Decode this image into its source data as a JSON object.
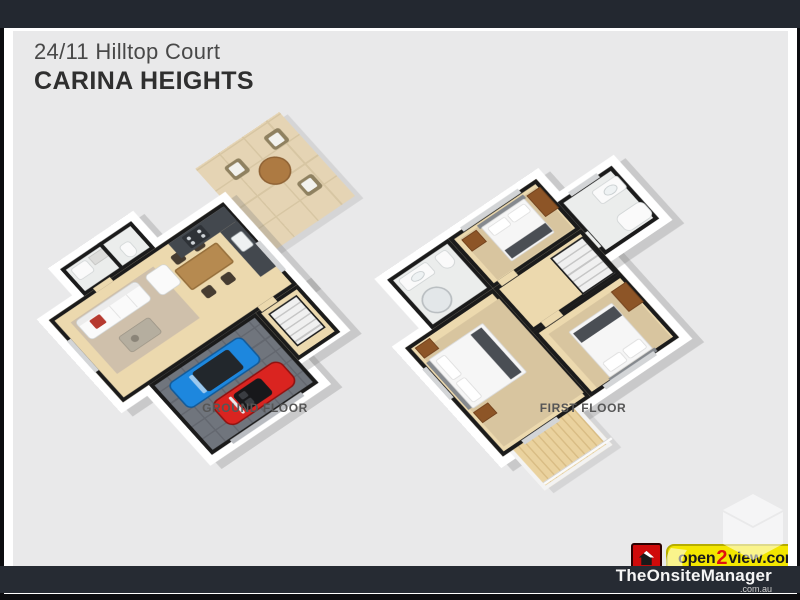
{
  "header": {
    "address_line": "24/11 Hilltop Court",
    "suburb_line": "CARINA HEIGHTS"
  },
  "floor_plans": [
    {
      "label": "GROUND FLOOR",
      "rooms": [
        "living room",
        "dining area",
        "kitchen",
        "laundry",
        "wc",
        "patio",
        "double garage",
        "entry with stairs"
      ],
      "features": [
        "white sofa with red cushion",
        "armchair",
        "coffee table",
        "timber dining table with four chairs",
        "dark kitchen counters with sink and stove",
        "outdoor table with three wicker chairs",
        "blue SUV",
        "red convertible"
      ]
    },
    {
      "label": "FIRST FLOOR",
      "rooms": [
        "bedroom 1",
        "bedroom 2",
        "bedroom 3",
        "bathroom",
        "ensuite",
        "hallway",
        "staircase",
        "balcony"
      ],
      "features": [
        "double beds with dark runners",
        "timber bedside tables and wardrobes",
        "vanity",
        "toilet",
        "shower",
        "bathtub",
        "timber balcony deck with balustrade"
      ]
    }
  ],
  "branding": {
    "logo_prefix": "open",
    "logo_digit": "2",
    "logo_suffix": "view",
    "logo_domain": ".com",
    "logo_registered": "®",
    "footer_brand": "TheOnsiteManager",
    "footer_domain": ".com.au"
  },
  "disclaimer": "Indicative only. Dimensions are approximate. All information contained herein is gathered from sources we believe to be reliable. However, we cannot guarantee its accuracy and interested persons should rely on their own enquiries.",
  "colors": {
    "top_bar": "#232830",
    "canvas": "#e9e9ea",
    "wall": "#1b1b1b",
    "wood_floor": "#ecd9ae",
    "garage_floor": "#70757d",
    "blue_car": "#1d87de",
    "red_car": "#da2420",
    "logo_yellow": "#f3e600",
    "logo_red": "#cf0a0a",
    "footer_bar": "#262b33"
  }
}
